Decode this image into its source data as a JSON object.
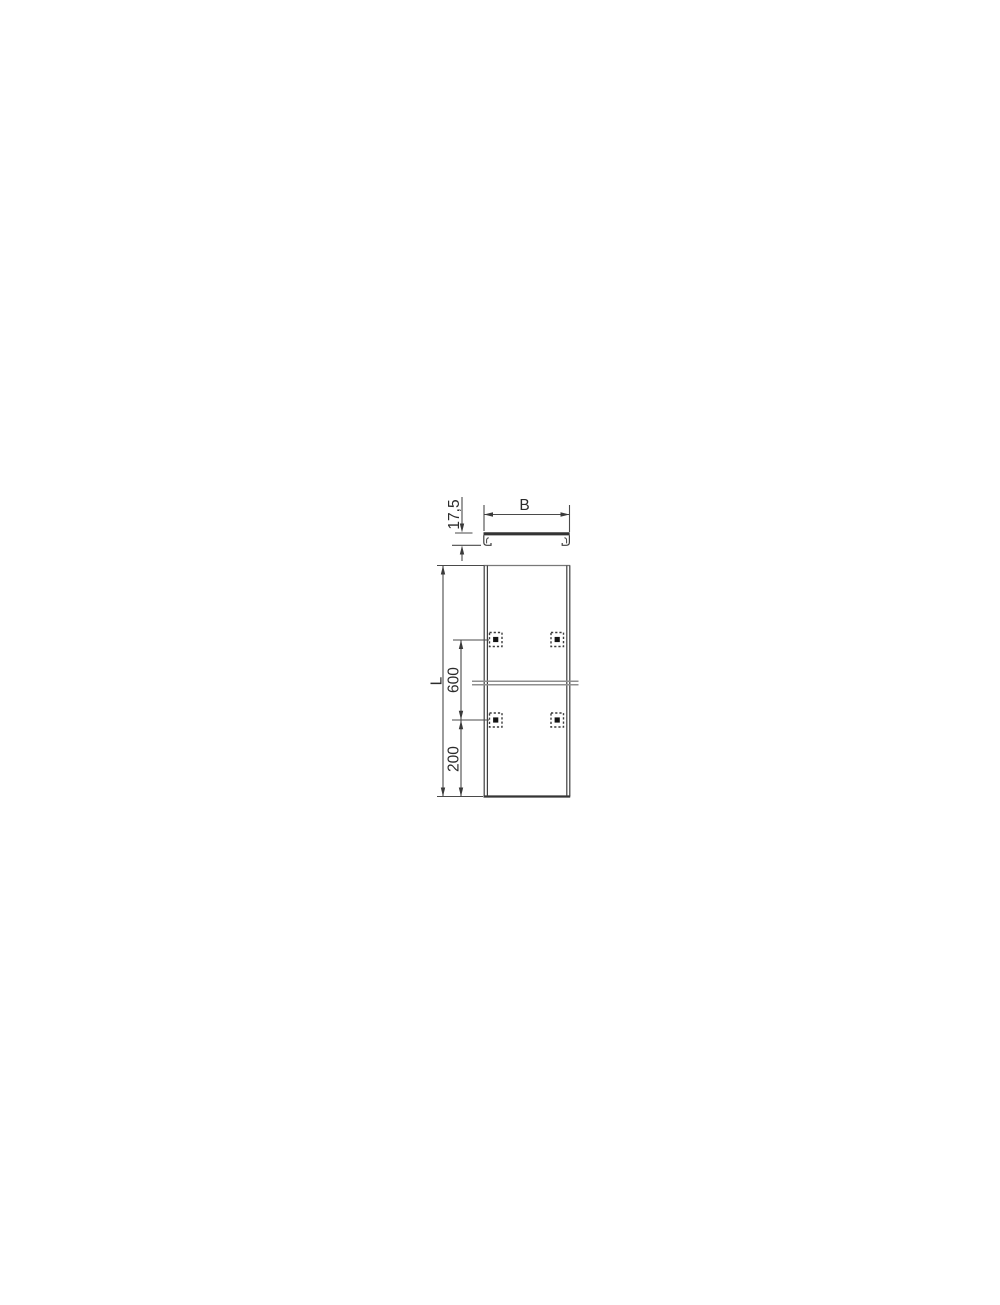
{
  "canvas": {
    "width": 1000,
    "height": 1300,
    "background": "#ffffff"
  },
  "drawing": {
    "kind": "technical dimensional drawing",
    "colors": {
      "line": "#3f3f3f",
      "dim_line": "#4a4a4a",
      "light_line": "#8f8f8f",
      "fastener_fill": "#141414",
      "text": "#2b2b2b"
    },
    "section_view": {
      "dim_width_label": "B",
      "dim_height_label": "17,5"
    },
    "plan_view": {
      "dim_length_label": "L",
      "dim_spacing_label": "600",
      "dim_end_label": "200",
      "fastener_icon": "turnbuckle-marker",
      "fastener_count": 4,
      "joint_icon": "joint-break-line"
    }
  }
}
